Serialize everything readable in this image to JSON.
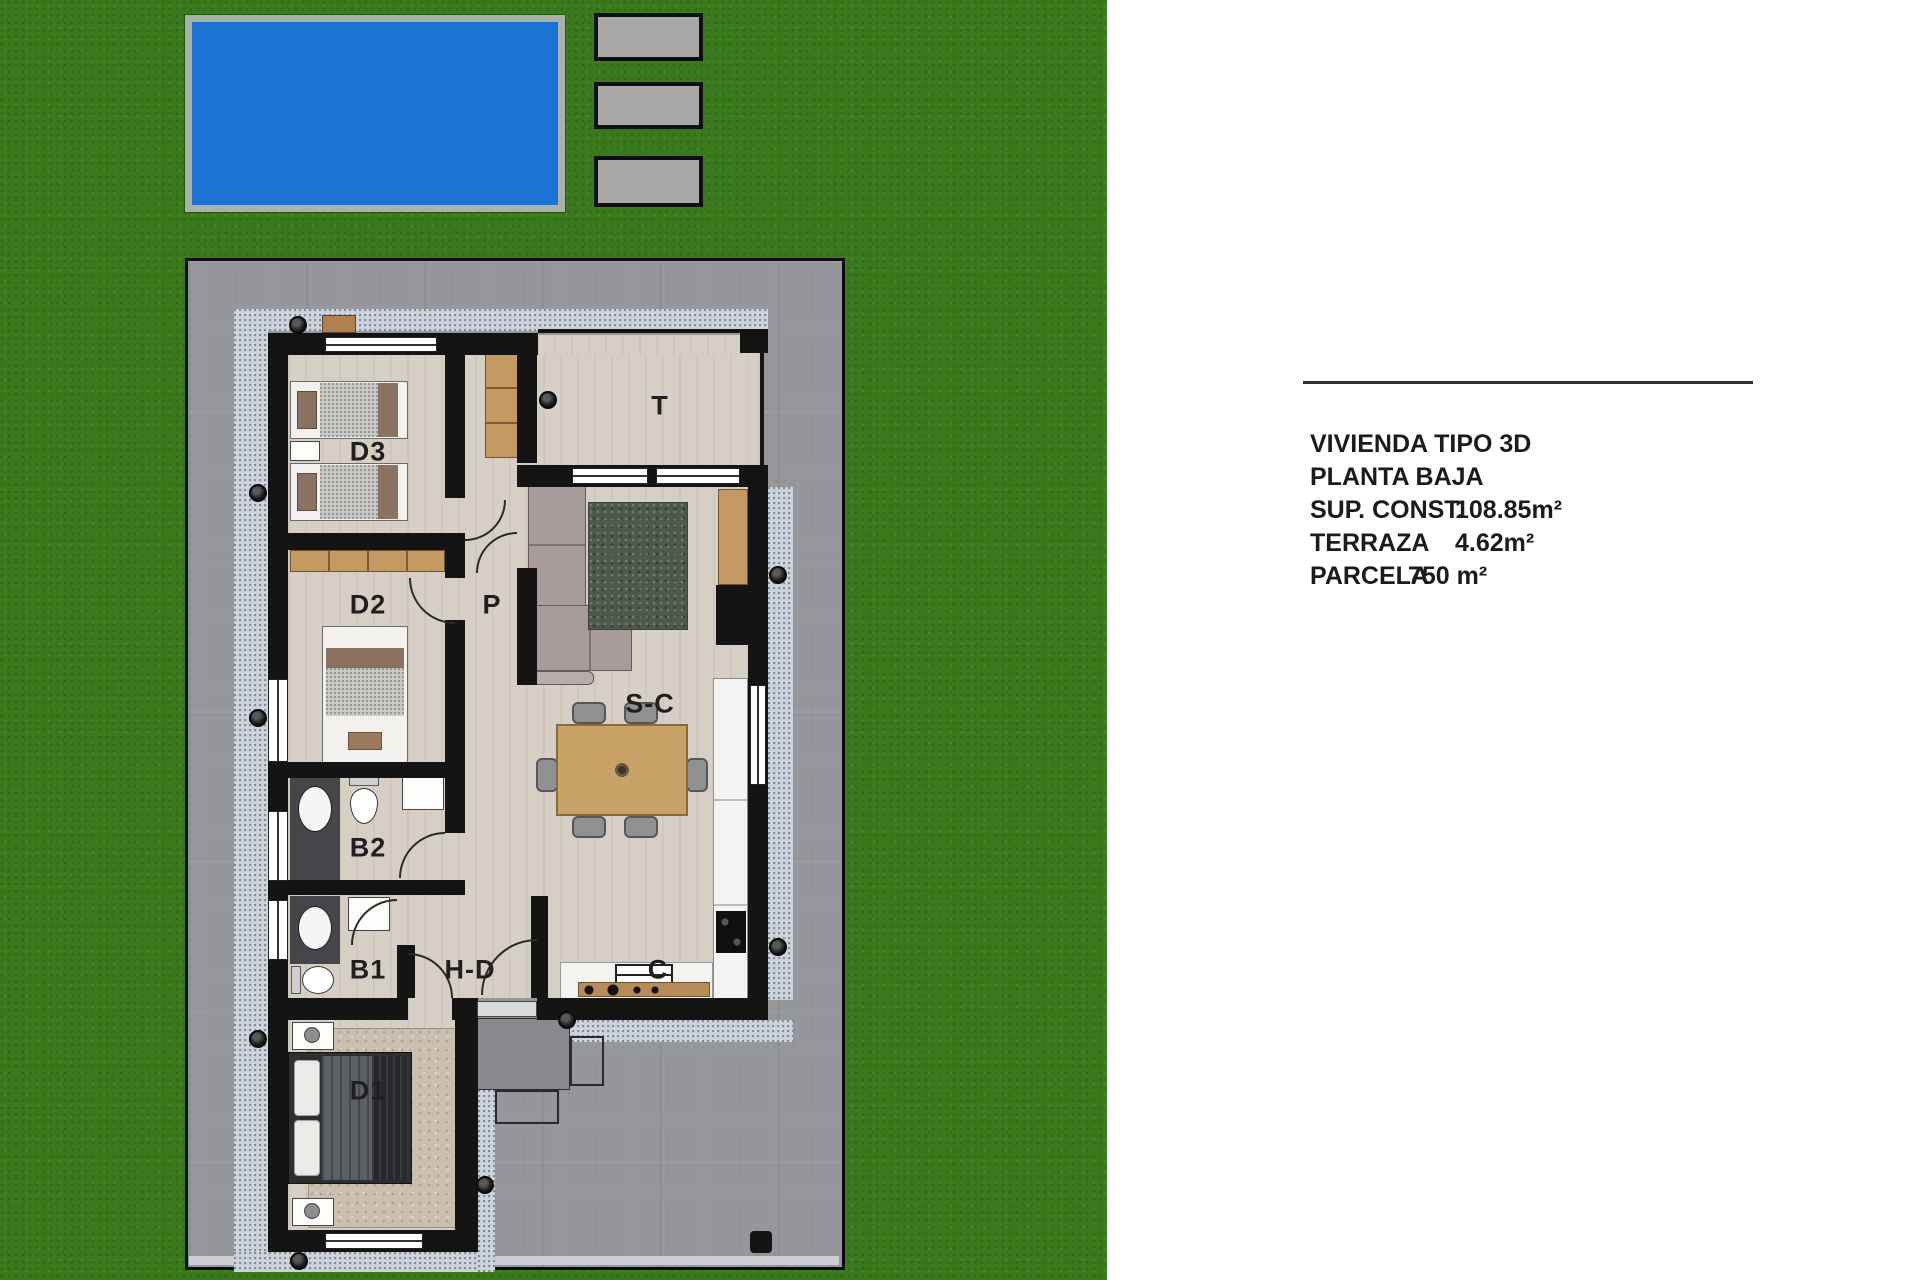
{
  "site": {
    "pool": {
      "name": "swimming-pool"
    },
    "parking_pads": [
      {
        "name": "pad-1"
      },
      {
        "name": "pad-2"
      },
      {
        "name": "pad-3"
      }
    ]
  },
  "floor_plan": {
    "rooms": [
      {
        "id": "D3",
        "label": "D3"
      },
      {
        "id": "D2",
        "label": "D2"
      },
      {
        "id": "P",
        "label": "P"
      },
      {
        "id": "T",
        "label": "T"
      },
      {
        "id": "S-C",
        "label": "S-C"
      },
      {
        "id": "B2",
        "label": "B2"
      },
      {
        "id": "B1",
        "label": "B1"
      },
      {
        "id": "H-D",
        "label": "H-D"
      },
      {
        "id": "C",
        "label": "C"
      },
      {
        "id": "D1",
        "label": "D1"
      }
    ]
  },
  "info_panel": {
    "lines": [
      {
        "label": "VIVIENDA TIPO 3D",
        "value": ""
      },
      {
        "label": "PLANTA BAJA",
        "value": ""
      },
      {
        "label": "SUP. CONST.",
        "value": "108.85m²"
      },
      {
        "label": "TERRAZA",
        "value": "4.62m²"
      },
      {
        "label": "PARCELA",
        "value": "750 m²"
      }
    ]
  },
  "colors": {
    "grass": "#3a7a1d",
    "pool_water": "#1a72d2",
    "pool_deck": "#a9b2a4",
    "concrete": "#96979a",
    "gravel": "#ccd3da",
    "wall": "#141414",
    "floor": "#d6cfc5",
    "wood": "#c49a62",
    "rug_green": "#4d5a4b",
    "rug_beige": "#cabfae",
    "sofa": "#a89b9b"
  }
}
